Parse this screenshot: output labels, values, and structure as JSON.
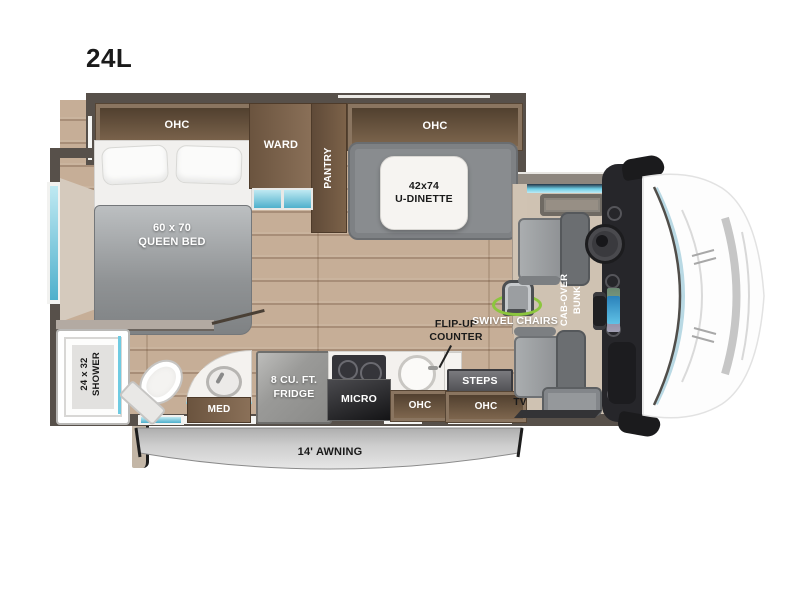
{
  "title": "24L",
  "labels": {
    "bedroom_ohc": "OHC",
    "queen_bed": "60 x 70\nQUEEN BED",
    "ward": "WARD",
    "pantry": "PANTRY",
    "dinette_ohc": "OHC",
    "dinette": "42x74\nU-DINETTE",
    "shower": "24 x 32\nSHOWER",
    "med": "MED",
    "fridge": "8 CU. FT.\nFRIDGE",
    "micro": "MICRO",
    "kitchen_ohc": "OHC",
    "steps": "STEPS",
    "entry_ohc": "OHC",
    "flip_up_counter": "FLIP-UP\nCOUNTER",
    "swivel_chairs": "SWIVEL CHAIRS",
    "cab_over_bunk": "CAB-OVER\nBUNK",
    "tv": "TV",
    "awning": "14' AWNING"
  },
  "colors": {
    "wall": "#57504a",
    "cabinet-frame": "#8a7560",
    "floor": "#c6ae97",
    "cab-tan": "#cfc2b2",
    "window-glass": "#6fcbe2",
    "accent-green": "#8cc63e",
    "seat": "#9b9ea1",
    "bench": "#898c8f",
    "awning-gray": "#c8c8c8",
    "dash": "#26262a"
  }
}
